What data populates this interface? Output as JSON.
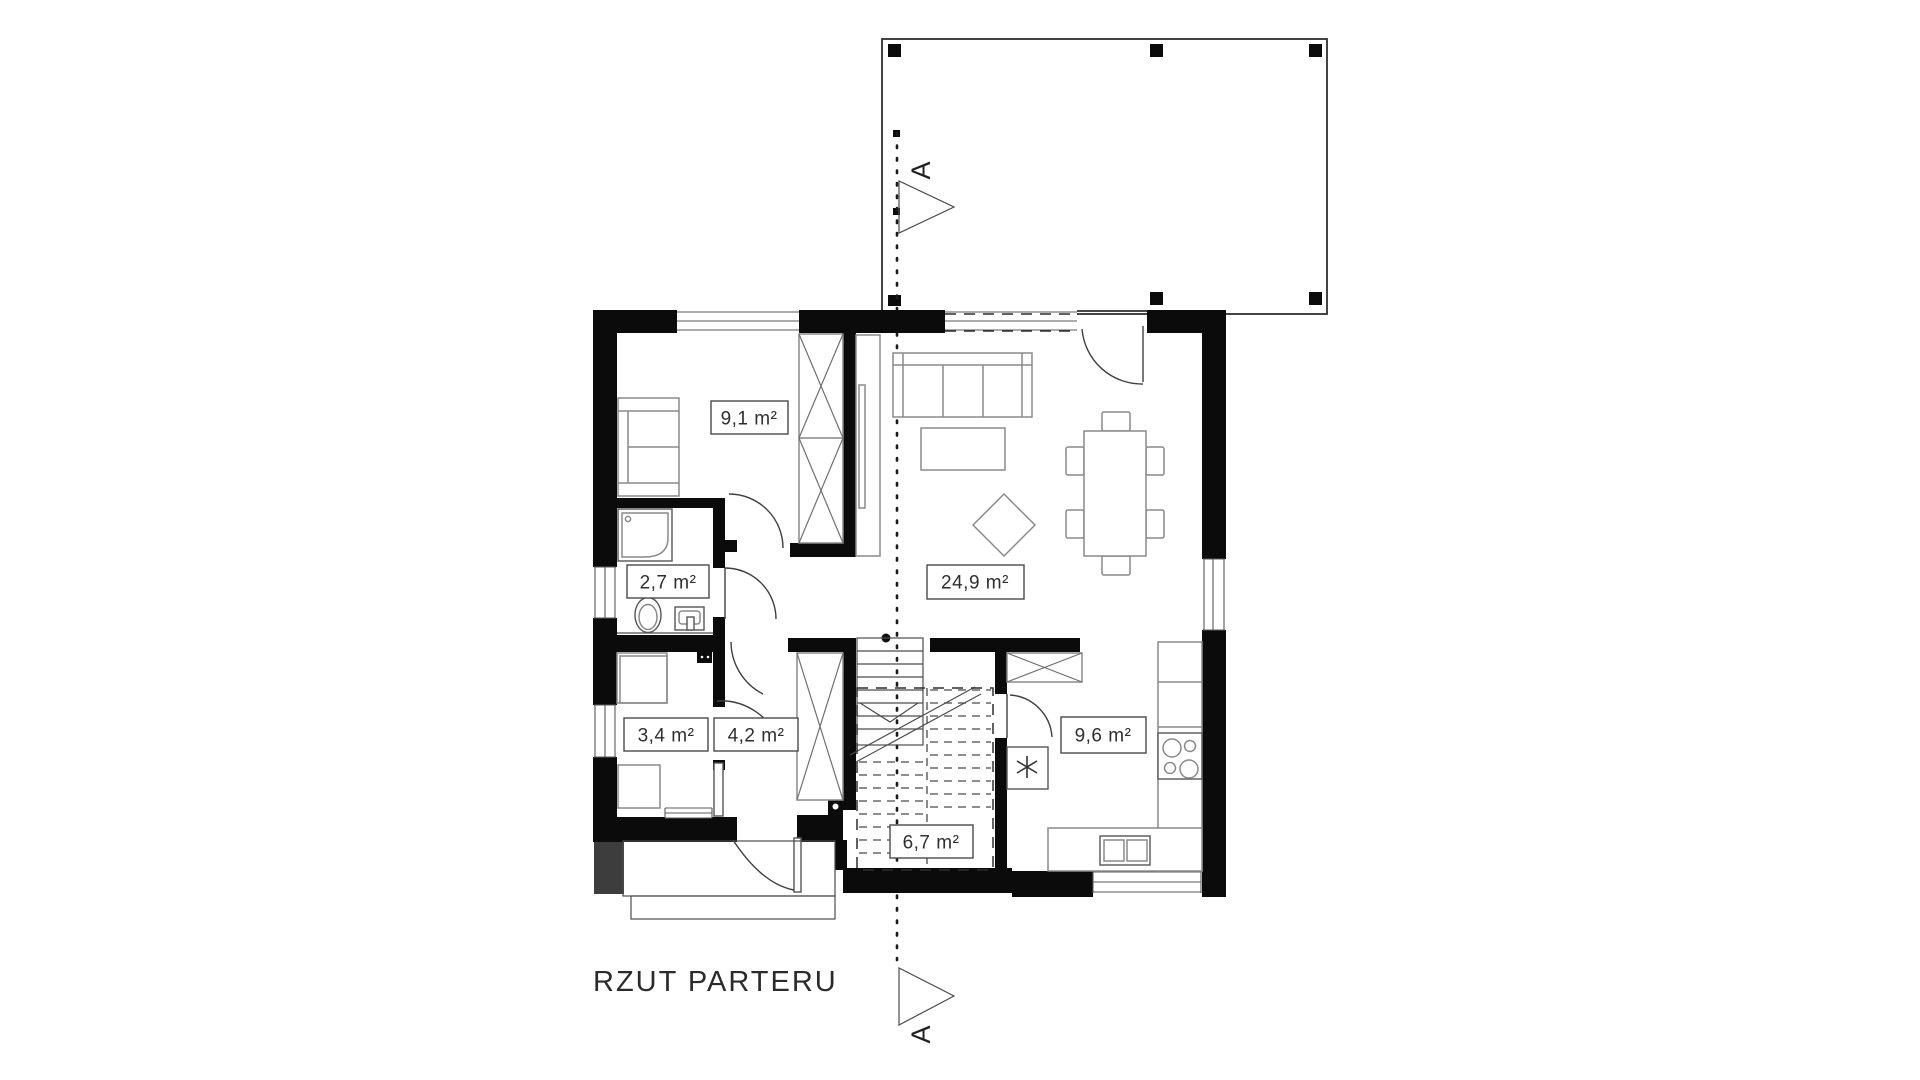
{
  "title": "RZUT PARTERU",
  "section_marker": "A",
  "rooms": {
    "bedroom": "9,1 m²",
    "bathroom": "2,7 m²",
    "wardrobe_room": "3,4 m²",
    "vestibule": "4,2 m²",
    "living_room": "24,9 m²",
    "stairs": "6,7 m²",
    "kitchen": "9,6 m²"
  },
  "colors": {
    "background": "#ffffff",
    "wall": "#0b0b0b",
    "line": "#3f3f3f",
    "furniture": "#8a8a8a",
    "text": "#2f2f2f"
  }
}
